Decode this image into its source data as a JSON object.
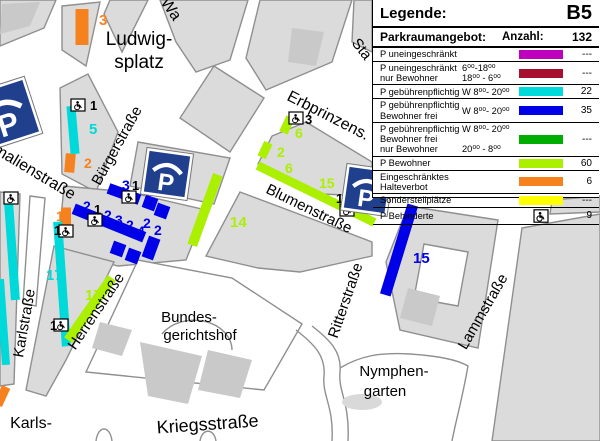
{
  "legend": {
    "title": "Legende:",
    "code": "B5",
    "col_offer": "Parkraumangebot:",
    "col_count": "Anzahl:",
    "total": "132",
    "rows": [
      {
        "label": "P uneingeschränkt",
        "times": "",
        "color": "#be00be",
        "count": "---"
      },
      {
        "label": "P uneingeschränkt\nnur Bewohner",
        "times": "6⁰⁰-18⁰⁰\n18⁰⁰ - 6⁰⁰",
        "color": "#a8102f",
        "count": "---"
      },
      {
        "label": "P gebührenpflichtig",
        "times": "W 8⁰⁰- 20⁰⁰",
        "color": "#00dada",
        "count": "22"
      },
      {
        "label": "P gebührenpflichtig\nBewohner frei",
        "times": "W 8⁰⁰- 20⁰⁰",
        "color": "#0000e8",
        "count": "35"
      },
      {
        "label": "P gebührenpflichtig\nBewohner frei\nnur Bewohner",
        "times": "W 8⁰⁰- 20⁰⁰\n\n20⁰⁰ - 8⁰⁰",
        "color": "#00ad00",
        "count": "---"
      },
      {
        "label": "P Bewohner",
        "times": "",
        "color": "#aaf000",
        "count": "60"
      },
      {
        "label": "Eingeschränktes Halteverbot",
        "times": "",
        "color": "#f6821f",
        "count": "6"
      },
      {
        "label": "Sonderstellplätze",
        "times": "",
        "color": "#ffff00",
        "count": "---"
      },
      {
        "label": "P Behinderte",
        "times": "",
        "icon": "wheelchair",
        "count": "9"
      }
    ]
  },
  "map": {
    "colors": {
      "cyan": "#00d9d9",
      "blue": "#0000e8",
      "greenyellow": "#aaf000",
      "orange": "#f6821f",
      "black": "#000000"
    },
    "street_labels": [
      {
        "text": "Ludwig-",
        "x": 139,
        "y": 45,
        "size": 19,
        "rot": 0
      },
      {
        "text": "splatz",
        "x": 139,
        "y": 68,
        "size": 19,
        "rot": 0
      },
      {
        "text": "Wa",
        "x": 167,
        "y": 12,
        "size": 16,
        "rot": 55
      },
      {
        "text": "Sta",
        "x": 358,
        "y": 52,
        "size": 15,
        "rot": 52
      },
      {
        "text": "Erbprinzens.",
        "x": 326,
        "y": 120,
        "size": 16,
        "rot": 27
      },
      {
        "text": "Bürgerstraße",
        "x": 121,
        "y": 148,
        "size": 15,
        "rot": -61
      },
      {
        "text": "malienstraße",
        "x": 32,
        "y": 176,
        "size": 16,
        "rot": 31
      },
      {
        "text": "Blumenstraße",
        "x": 307,
        "y": 213,
        "size": 15,
        "rot": 26
      },
      {
        "text": "Karlstraße",
        "x": 29,
        "y": 324,
        "size": 15,
        "rot": -80
      },
      {
        "text": "Herrenstraße",
        "x": 100,
        "y": 314,
        "size": 15,
        "rot": -56
      },
      {
        "text": "Bundes-",
        "x": 189,
        "y": 322,
        "size": 15,
        "rot": 0
      },
      {
        "text": "gerichtshof",
        "x": 200,
        "y": 340,
        "size": 15,
        "rot": 0
      },
      {
        "text": "Ritterstraße",
        "x": 350,
        "y": 302,
        "size": 15,
        "rot": -71
      },
      {
        "text": "Lammstraße",
        "x": 487,
        "y": 314,
        "size": 15,
        "rot": -60
      },
      {
        "text": "Nymphen-",
        "x": 394,
        "y": 376,
        "size": 15,
        "rot": 0
      },
      {
        "text": "garten",
        "x": 385,
        "y": 396,
        "size": 15,
        "rot": 0
      },
      {
        "text": "Kriegsstraße",
        "x": 208,
        "y": 430,
        "size": 18,
        "rot": -4
      },
      {
        "text": "Karls-",
        "x": 31,
        "y": 428,
        "size": 16,
        "rot": 0
      }
    ],
    "bars": [
      {
        "x": 82,
        "y": 27,
        "w": 13,
        "h": 36,
        "r": 0,
        "color": "orange"
      },
      {
        "x": 70,
        "y": 163,
        "w": 10,
        "h": 19,
        "r": 5,
        "color": "orange"
      },
      {
        "x": 66,
        "y": 216,
        "w": 10,
        "h": 17,
        "r": 0,
        "color": "orange"
      },
      {
        "x": 2,
        "y": 396,
        "w": 9,
        "h": 20,
        "r": 25,
        "color": "orange"
      },
      {
        "x": 73,
        "y": 130,
        "w": 9,
        "h": 48,
        "r": -5,
        "color": "cyan"
      },
      {
        "x": 12,
        "y": 251,
        "w": 9,
        "h": 98,
        "r": -4,
        "color": "cyan"
      },
      {
        "x": 3,
        "y": 322,
        "w": 8,
        "h": 86,
        "r": -4,
        "color": "cyan"
      },
      {
        "x": 62,
        "y": 284,
        "w": 9,
        "h": 125,
        "r": -4,
        "color": "cyan"
      },
      {
        "x": 124,
        "y": 194,
        "w": 33,
        "h": 11,
        "r": 20,
        "color": "blue"
      },
      {
        "x": 150,
        "y": 203,
        "w": 13,
        "h": 13,
        "r": 20,
        "color": "blue"
      },
      {
        "x": 162,
        "y": 211,
        "w": 13,
        "h": 13,
        "r": 20,
        "color": "blue"
      },
      {
        "x": 109,
        "y": 223,
        "w": 76,
        "h": 11,
        "r": 22,
        "color": "blue"
      },
      {
        "x": 151,
        "y": 248,
        "w": 12,
        "h": 22,
        "r": 20,
        "color": "blue"
      },
      {
        "x": 118,
        "y": 249,
        "w": 13,
        "h": 13,
        "r": 20,
        "color": "blue"
      },
      {
        "x": 133,
        "y": 256,
        "w": 13,
        "h": 13,
        "r": 20,
        "color": "blue"
      },
      {
        "x": 399,
        "y": 250,
        "w": 11,
        "h": 94,
        "r": 17,
        "color": "blue"
      },
      {
        "x": 287,
        "y": 125,
        "w": 9,
        "h": 17,
        "r": 25,
        "color": "greenyellow"
      },
      {
        "x": 265,
        "y": 150,
        "w": 9,
        "h": 16,
        "r": 25,
        "color": "greenyellow"
      },
      {
        "x": 316,
        "y": 194,
        "w": 130,
        "h": 9,
        "r": 26,
        "color": "greenyellow"
      },
      {
        "x": 205,
        "y": 210,
        "w": 10,
        "h": 75,
        "r": 20,
        "color": "greenyellow"
      },
      {
        "x": 90,
        "y": 309,
        "w": 10,
        "h": 76,
        "r": 35,
        "color": "greenyellow"
      }
    ],
    "bar_labels": [
      {
        "text": "3",
        "x": 99,
        "y": 25,
        "size": 15,
        "color": "orange"
      },
      {
        "text": "2",
        "x": 84,
        "y": 168,
        "size": 14,
        "color": "orange"
      },
      {
        "text": "1",
        "x": 56,
        "y": 221,
        "size": 14,
        "color": "orange"
      },
      {
        "text": "5",
        "x": 89,
        "y": 134,
        "size": 15,
        "color": "cyan"
      },
      {
        "text": "17",
        "x": 46,
        "y": 280,
        "size": 15,
        "color": "cyan"
      },
      {
        "text": "3",
        "x": 122,
        "y": 190,
        "size": 14,
        "color": "blue"
      },
      {
        "text": "2",
        "x": 83,
        "y": 211,
        "size": 14,
        "color": "blue"
      },
      {
        "text": "2",
        "x": 104,
        "y": 220,
        "size": 14,
        "color": "blue"
      },
      {
        "text": "3",
        "x": 115,
        "y": 225,
        "size": 14,
        "color": "blue"
      },
      {
        "text": "2",
        "x": 126,
        "y": 230,
        "size": 14,
        "color": "blue"
      },
      {
        "text": "4",
        "x": 137,
        "y": 236,
        "size": 14,
        "color": "blue"
      },
      {
        "text": "2",
        "x": 143,
        "y": 228,
        "size": 14,
        "color": "blue"
      },
      {
        "text": "2",
        "x": 154,
        "y": 235,
        "size": 14,
        "color": "blue"
      },
      {
        "text": "15",
        "x": 413,
        "y": 263,
        "size": 15,
        "color": "blue"
      },
      {
        "text": "6",
        "x": 295,
        "y": 138,
        "size": 14,
        "color": "greenyellow"
      },
      {
        "text": "2",
        "x": 277,
        "y": 157,
        "size": 14,
        "color": "greenyellow"
      },
      {
        "text": "6",
        "x": 285,
        "y": 173,
        "size": 14,
        "color": "greenyellow"
      },
      {
        "text": "15",
        "x": 319,
        "y": 188,
        "size": 14,
        "color": "greenyellow"
      },
      {
        "text": "14",
        "x": 230,
        "y": 227,
        "size": 15,
        "color": "greenyellow"
      },
      {
        "text": "17",
        "x": 85,
        "y": 300,
        "size": 15,
        "color": "greenyellow"
      }
    ],
    "disabled_spots": [
      {
        "x": 78,
        "y": 105,
        "num": "1",
        "nx": 90,
        "ny": 110
      },
      {
        "x": 11,
        "y": 198,
        "num": "",
        "nx": 0,
        "ny": 0
      },
      {
        "x": 129,
        "y": 197,
        "num": "1",
        "nx": 132,
        "ny": 190
      },
      {
        "x": 95,
        "y": 220,
        "num": "1",
        "nx": 94,
        "ny": 214
      },
      {
        "x": 66,
        "y": 231,
        "num": "1",
        "nx": 54,
        "ny": 235
      },
      {
        "x": 296,
        "y": 118,
        "num": "3",
        "nx": 305,
        "ny": 124
      },
      {
        "x": 347,
        "y": 210,
        "num": "1",
        "nx": 336,
        "ny": 203
      },
      {
        "x": 61,
        "y": 325,
        "num": "1",
        "nx": 50,
        "ny": 330
      }
    ],
    "garages": [
      {
        "x": 5,
        "y": 114,
        "s": 60,
        "r": -18
      },
      {
        "x": 167,
        "y": 174,
        "s": 47,
        "r": 8
      },
      {
        "x": 367,
        "y": 190,
        "s": 47,
        "r": 8
      }
    ]
  }
}
